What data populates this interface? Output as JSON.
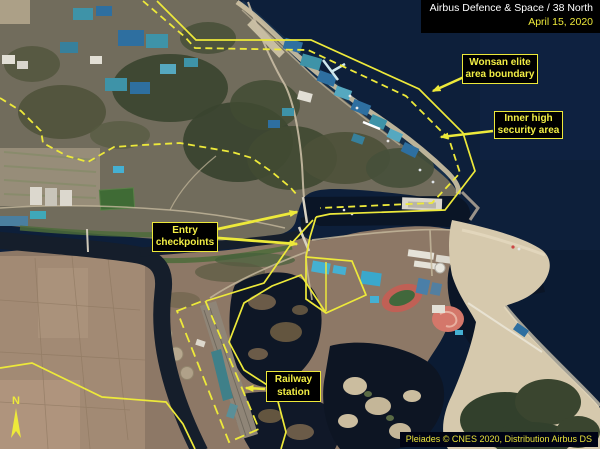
{
  "header": {
    "line1": "Airbus Defence & Space / 38 North",
    "line2": "April 15, 2020"
  },
  "annotations": {
    "wonsan_boundary": {
      "line1": "Wonsan elite",
      "line2": "area boundary"
    },
    "inner_security": {
      "line1": "Inner high",
      "line2": "security area"
    },
    "entry_checkpoints": {
      "line1": "Entry",
      "line2": "checkpoints"
    },
    "railway_station": {
      "line1": "Railway",
      "line2": "station"
    }
  },
  "attribution": {
    "text": "Pleiades © CNES 2020, Distribution Airbus DS"
  },
  "north_arrow": {
    "label": "N"
  },
  "colors": {
    "annotation_yellow": "#ede93a",
    "header_text_white": "#ffffff",
    "header_date_yellow": "#ede93a",
    "label_background": "#000000",
    "sea_navy": "#0d1f3a"
  }
}
